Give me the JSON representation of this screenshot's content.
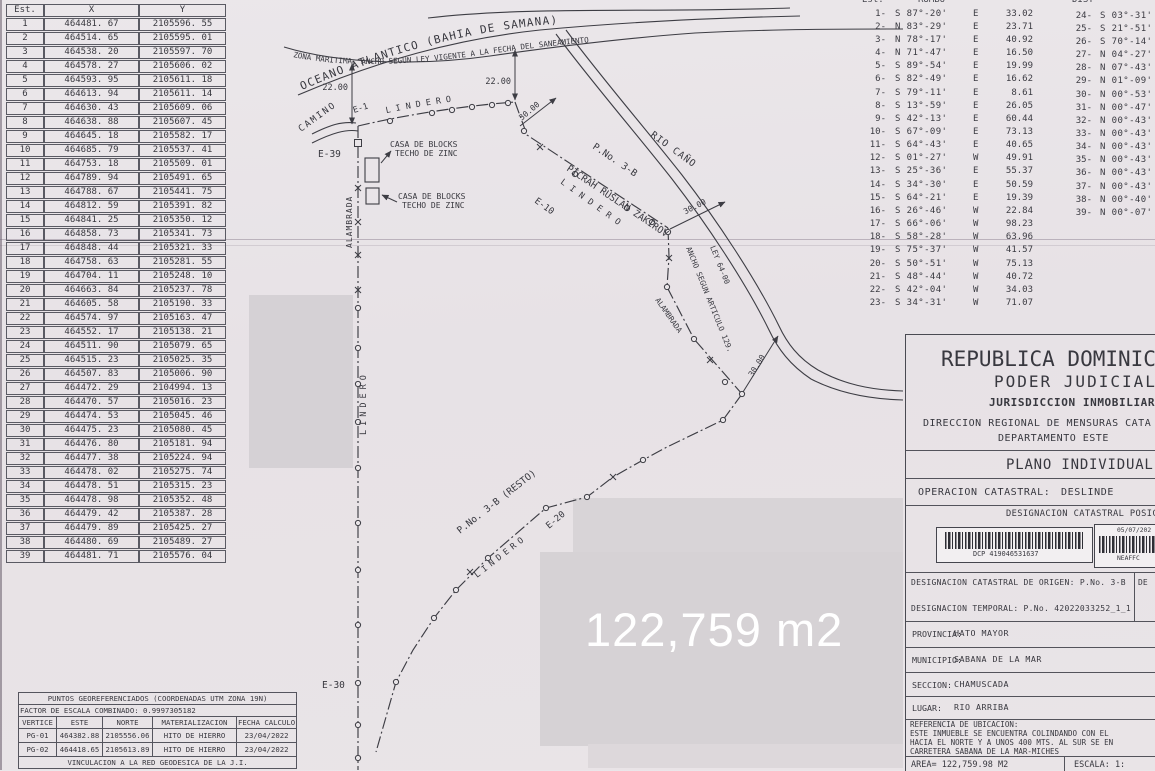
{
  "scan": {
    "area_overlay": "122,759 m2"
  },
  "coord_table": {
    "headers": [
      "Est.",
      "X",
      "Y"
    ],
    "rows": [
      [
        "1",
        "464481. 67",
        "2105596. 55"
      ],
      [
        "2",
        "464514. 65",
        "2105595. 01"
      ],
      [
        "3",
        "464538. 20",
        "2105597. 70"
      ],
      [
        "4",
        "464578. 27",
        "2105606. 02"
      ],
      [
        "5",
        "464593. 95",
        "2105611. 18"
      ],
      [
        "6",
        "464613. 94",
        "2105611. 14"
      ],
      [
        "7",
        "464630. 43",
        "2105609. 06"
      ],
      [
        "8",
        "464638. 88",
        "2105607. 45"
      ],
      [
        "9",
        "464645. 18",
        "2105582. 17"
      ],
      [
        "10",
        "464685. 79",
        "2105537. 41"
      ],
      [
        "11",
        "464753. 18",
        "2105509. 01"
      ],
      [
        "12",
        "464789. 94",
        "2105491. 65"
      ],
      [
        "13",
        "464788. 67",
        "2105441. 75"
      ],
      [
        "14",
        "464812. 59",
        "2105391. 82"
      ],
      [
        "15",
        "464841. 25",
        "2105350. 12"
      ],
      [
        "16",
        "464858. 73",
        "2105341. 73"
      ],
      [
        "17",
        "464848. 44",
        "2105321. 33"
      ],
      [
        "18",
        "464758. 63",
        "2105281. 55"
      ],
      [
        "19",
        "464704. 11",
        "2105248. 10"
      ],
      [
        "20",
        "464663. 84",
        "2105237. 78"
      ],
      [
        "21",
        "464605. 58",
        "2105190. 33"
      ],
      [
        "22",
        "464574. 97",
        "2105163. 47"
      ],
      [
        "23",
        "464552. 17",
        "2105138. 21"
      ],
      [
        "24",
        "464511. 90",
        "2105079. 65"
      ],
      [
        "25",
        "464515. 23",
        "2105025. 35"
      ],
      [
        "26",
        "464507. 83",
        "2105006. 90"
      ],
      [
        "27",
        "464472. 29",
        "2104994. 13"
      ],
      [
        "28",
        "464470. 57",
        "2105016. 23"
      ],
      [
        "29",
        "464474. 53",
        "2105045. 46"
      ],
      [
        "30",
        "464475. 23",
        "2105080. 45"
      ],
      [
        "31",
        "464476. 80",
        "2105181. 94"
      ],
      [
        "32",
        "464477. 38",
        "2105224. 94"
      ],
      [
        "33",
        "464478. 02",
        "2105275. 74"
      ],
      [
        "34",
        "464478. 51",
        "2105315. 23"
      ],
      [
        "35",
        "464478. 98",
        "2105352. 48"
      ],
      [
        "36",
        "464479. 42",
        "2105387. 28"
      ],
      [
        "37",
        "464479. 89",
        "2105425. 27"
      ],
      [
        "38",
        "464480. 69",
        "2105489. 27"
      ],
      [
        "39",
        "464481. 71",
        "2105576. 04"
      ]
    ]
  },
  "bearing_table": {
    "header": {
      "est": "Est.",
      "rumbo": "RUMBO",
      "dist": "DIST"
    },
    "left": [
      {
        "n": "1-",
        "b": "S 87°-20'",
        "q": "E",
        "d": "33.02"
      },
      {
        "n": "2-",
        "b": "N 83°-29'",
        "q": "E",
        "d": "23.71"
      },
      {
        "n": "3-",
        "b": "N 78°-17'",
        "q": "E",
        "d": "40.92"
      },
      {
        "n": "4-",
        "b": "N 71°-47'",
        "q": "E",
        "d": "16.50"
      },
      {
        "n": "5-",
        "b": "S 89°-54'",
        "q": "E",
        "d": "19.99"
      },
      {
        "n": "6-",
        "b": "S 82°-49'",
        "q": "E",
        "d": "16.62"
      },
      {
        "n": "7-",
        "b": "S 79°-11'",
        "q": "E",
        "d": "8.61"
      },
      {
        "n": "8-",
        "b": "S 13°-59'",
        "q": "E",
        "d": "26.05"
      },
      {
        "n": "9-",
        "b": "S 42°-13'",
        "q": "E",
        "d": "60.44"
      },
      {
        "n": "10-",
        "b": "S 67°-09'",
        "q": "E",
        "d": "73.13"
      },
      {
        "n": "11-",
        "b": "S 64°-43'",
        "q": "E",
        "d": "40.65"
      },
      {
        "n": "12-",
        "b": "S 01°-27'",
        "q": "W",
        "d": "49.91"
      },
      {
        "n": "13-",
        "b": "S 25°-36'",
        "q": "E",
        "d": "55.37"
      },
      {
        "n": "14-",
        "b": "S 34°-30'",
        "q": "E",
        "d": "50.59"
      },
      {
        "n": "15-",
        "b": "S 64°-21'",
        "q": "E",
        "d": "19.39"
      },
      {
        "n": "16-",
        "b": "S 26°-46'",
        "q": "W",
        "d": "22.84"
      },
      {
        "n": "17-",
        "b": "S 66°-06'",
        "q": "W",
        "d": "98.23"
      },
      {
        "n": "18-",
        "b": "S 58°-28'",
        "q": "W",
        "d": "63.96"
      },
      {
        "n": "19-",
        "b": "S 75°-37'",
        "q": "W",
        "d": "41.57"
      },
      {
        "n": "20-",
        "b": "S 50°-51'",
        "q": "W",
        "d": "75.13"
      },
      {
        "n": "21-",
        "b": "S 48°-44'",
        "q": "W",
        "d": "40.72"
      },
      {
        "n": "22-",
        "b": "S 42°-04'",
        "q": "W",
        "d": "34.03"
      },
      {
        "n": "23-",
        "b": "S 34°-31'",
        "q": "W",
        "d": "71.07"
      }
    ],
    "right": [
      {
        "n": "24-",
        "b": "S 03°-31'"
      },
      {
        "n": "25-",
        "b": "S 21°-51'"
      },
      {
        "n": "26-",
        "b": "S 70°-14'"
      },
      {
        "n": "27-",
        "b": "N 04°-27'"
      },
      {
        "n": "28-",
        "b": "N 07°-43'"
      },
      {
        "n": "29-",
        "b": "N 01°-09'"
      },
      {
        "n": "30-",
        "b": "N 00°-53'"
      },
      {
        "n": "31-",
        "b": "N 00°-47'"
      },
      {
        "n": "32-",
        "b": "N 00°-43'"
      },
      {
        "n": "33-",
        "b": "N 00°-43'"
      },
      {
        "n": "34-",
        "b": "N 00°-43'"
      },
      {
        "n": "35-",
        "b": "N 00°-43'"
      },
      {
        "n": "36-",
        "b": "N 00°-43'"
      },
      {
        "n": "37-",
        "b": "N 00°-43'"
      },
      {
        "n": "38-",
        "b": "N 00°-40'"
      },
      {
        "n": "39-",
        "b": "N 00°-07'"
      }
    ]
  },
  "map": {
    "labels": {
      "ocean": "OCEANO ATLANTICO (BAHIA DE SAMANA)",
      "zona": "ZONA MARITIMA, ANCHO SEGUN LEY VIGENTE A LA FECHA DEL SANEAMIENTO",
      "camino": "CAMINO",
      "e1": "E-1",
      "e39": "E-39",
      "e10": "E-10",
      "e20": "E-20",
      "e30": "E-30",
      "lindero": "LINDERO",
      "casa1": "CASA DE BLOCKS",
      "casa2": "TECHO DE ZINC",
      "alambrada": "ALAMBRADA",
      "rio": "RIO CAÑO",
      "parcel": "P.No. 3-B",
      "owner": "PICRAH RUSLAN ZAKIROV",
      "resto": "P.No. 3-B (RESTO)",
      "ancho1": "ANCHO SEGUN ARTICULO 129.",
      "ancho2": "LEY 64-00",
      "d22": "22.00",
      "d30": "30.00"
    }
  },
  "panel": {
    "title1": "REPUBLICA DOMINIC",
    "title2": "PODER JUDICIAL",
    "title3": "JURISDICCION INMOBILIAR",
    "title4": "DIRECCION REGIONAL DE MENSURAS CATA",
    "title5": "DEPARTAMENTO ESTE",
    "plano": "PLANO INDIVIDUAL",
    "operacion_label": "OPERACION CATASTRAL:",
    "operacion_value": "DESLINDE",
    "desig_posicional": "DESIGNACION CATASTRAL POSIC",
    "barcode1_code": "DCP 419046531637",
    "barcode2_date": "05/07/202",
    "barcode2_code": "NEAFFC",
    "origen": "DESIGNACION CATASTRAL DE ORIGEN: P.No. 3-B",
    "origen_partial": "DE",
    "temporal": "DESIGNACION TEMPORAL: P.No. 42022033252_1_1",
    "provincia_label": "PROVINCIA:",
    "provincia": "HATO MAYOR",
    "municipio_label": "MUNICIPIO:",
    "municipio": "SABANA DE LA MAR",
    "seccion_label": "SECCION:",
    "seccion": "CHAMUSCADA",
    "lugar_label": "LUGAR:",
    "lugar": "RIO ARRIBA",
    "ref_title": "REFERENCIA DE UBICACION:",
    "ref_line1": "ESTE INMUEBLE SE ENCUENTRA COLINDANDO CON EL",
    "ref_line2": "HACIA EL NORTE Y A UNOS 400 MTS. AL SUR SE EN",
    "ref_line3": "CARRETERA SABANA DE LA MAR-MICHES",
    "area": "AREA= 122,759.98 M2",
    "escala": "ESCALA: 1:"
  },
  "georef_table": {
    "title": "PUNTOS GEOREFERENCIADOS (COORDENADAS UTM ZONA 19N)",
    "factor": "FACTOR DE ESCALA COMBINADO: 0.9997305182",
    "headers": [
      "VERTICE",
      "ESTE",
      "NORTE",
      "MATERIALIZACION",
      "FECHA CALCULO"
    ],
    "rows": [
      [
        "PG-01",
        "464382.88",
        "2105556.06",
        "HITO DE HIERRO",
        "23/04/2022"
      ],
      [
        "PG-02",
        "464418.65",
        "2105613.89",
        "HITO DE HIERRO",
        "23/04/2022"
      ]
    ],
    "footer": "VINCULACION A LA RED GEODESICA DE LA J.I."
  }
}
